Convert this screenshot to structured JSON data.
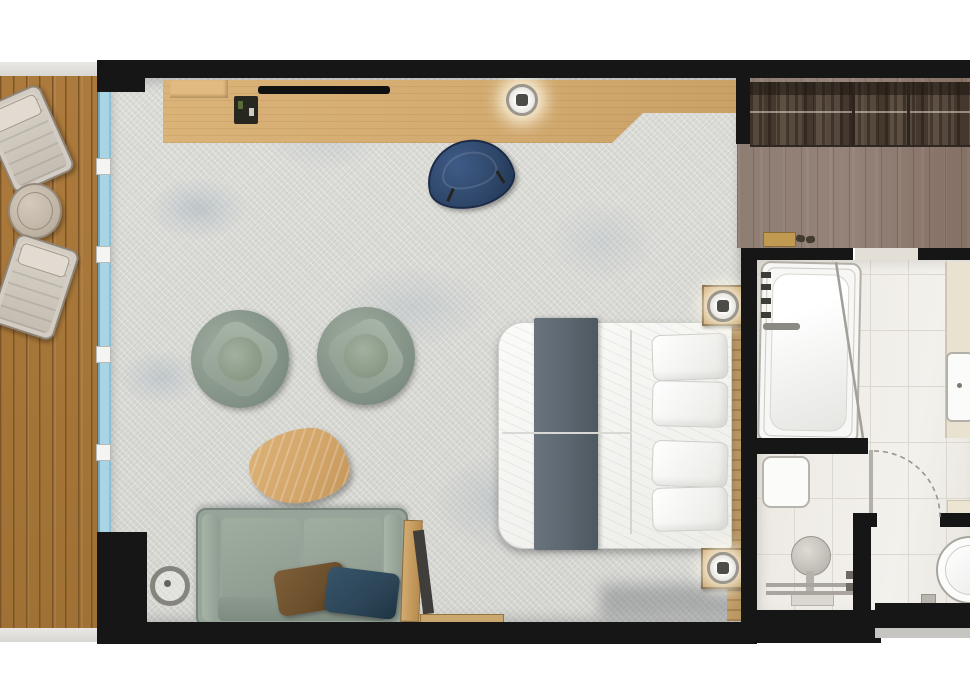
{
  "document": {
    "type": "floor-plan",
    "view": "top-down",
    "text_visible": false
  },
  "palette": {
    "wall": "#161616",
    "deck_wood": "#ac7a3c",
    "deck_plank_line": "#7c5526",
    "rail": "#e9e8e5",
    "window_glass": "#a9d4e5",
    "floor_base": "#dcdcd7",
    "desk_wood": "#d3ab71",
    "tv_black": "#111111",
    "chair_navy": "#2e4668",
    "sage": "#94a296",
    "sage_dark": "#7e8d82",
    "table_wood": "#d3a569",
    "runner_gray": "#5d6770",
    "linen_white": "#f5f5f3",
    "headboard_wood": "#b6945f",
    "nightstand_wood": "#c09659",
    "corridor_wood": "#95837a",
    "wardrobe_wood": "#5d4f44",
    "tile": "#efece7",
    "tile_line": "#dcd8d1",
    "fixture_white": "#fbfbfa",
    "fixture_line": "#b3b0aa",
    "vanity_cream": "#e9e2d1",
    "pillow_brown": "#6b4f2c",
    "pillow_teal": "#2c4557",
    "metal_gray": "#8b8983"
  },
  "plan": {
    "balcony": {
      "items": [
        "sun-lounger",
        "round-side-table",
        "sun-lounger"
      ]
    },
    "bedroom": {
      "items": [
        "desk-console",
        "desk-shelf",
        "minibar-tray",
        "tv",
        "ceiling-light",
        "desk-chair",
        "armchair",
        "armchair",
        "coffee-table",
        "sofa",
        "cushion-brown",
        "cushion-teal",
        "floor-lamp",
        "leaning-mirror",
        "double-bed",
        "bed-runner",
        "bed-pillows",
        "headboard-panel",
        "nightstand-with-lamp",
        "nightstand-with-lamp",
        "window-wall"
      ]
    },
    "entry": {
      "items": [
        "wardrobe-with-hanging-clothes",
        "doormat",
        "slippers"
      ]
    },
    "bathroom": {
      "items": [
        "bathtub",
        "tub-faucet",
        "glass-screen",
        "vanity-counter",
        "washbasin",
        "shower-bench",
        "rain-shower-head",
        "shower-rails",
        "shower-controls",
        "wc-door",
        "door-swing-arc",
        "toilet",
        "shelf"
      ]
    }
  }
}
